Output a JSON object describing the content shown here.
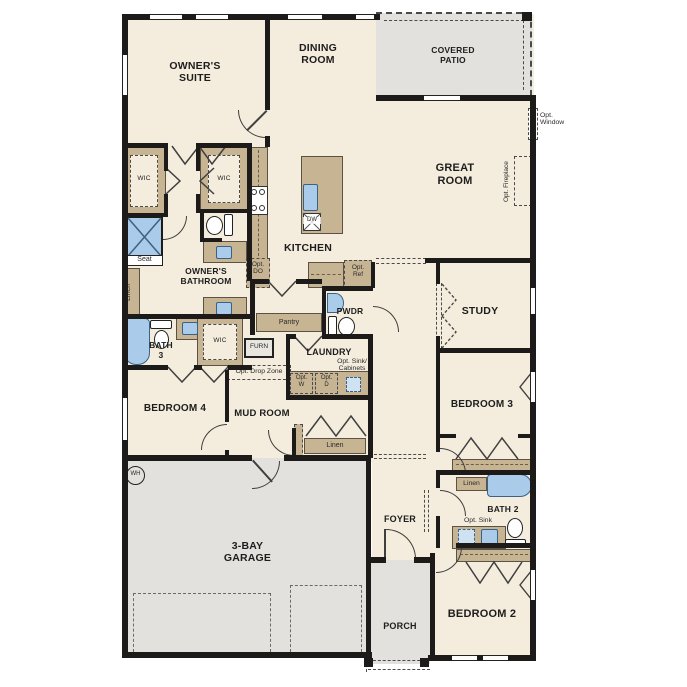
{
  "rooms": {
    "owners_suite": "OWNER'S\nSUITE",
    "dining_room": "DINING\nROOM",
    "covered_patio": "COVERED\nPATIO",
    "great_room": "GREAT\nROOM",
    "kitchen": "KITCHEN",
    "owners_bathroom": "OWNER'S\nBATHROOM",
    "wic_left": "WIC",
    "wic_mid": "WIC",
    "wic_bedroom4": "WIC",
    "bath_3": "BATH\n3",
    "bedroom_4": "BEDROOM 4",
    "mud_room": "MUD ROOM",
    "laundry": "LAUNDRY",
    "pwdr": "PWDR",
    "study": "STUDY",
    "bedroom_3": "BEDROOM 3",
    "bath_2": "BATH 2",
    "bedroom_2": "BEDROOM 2",
    "foyer": "FOYER",
    "porch": "PORCH",
    "garage": "3-BAY\nGARAGE"
  },
  "ann": {
    "seat": "Seat",
    "linen_owner": "Linen",
    "linen_hall": "Linen",
    "linen_bath2": "Linen",
    "pantry": "Pantry",
    "furn": "FURN",
    "dw": "DW",
    "wh": "WH",
    "opt_do": "Opt.\nDO",
    "opt_ref": "Opt.\nRef",
    "opt_drop_zone": "Opt. Drop Zone",
    "opt_w": "Opt.\nW",
    "opt_d": "Opt.\nD",
    "opt_sink_cabinets": "Opt. Sink/\nCabinets",
    "opt_sink": "Opt. Sink",
    "opt_window": "Opt.\nWindow",
    "opt_fireplace": "Opt. Fireplace"
  },
  "colors": {
    "floor": "#f4eddd",
    "exterior_concrete": "#e3e1dd",
    "wall": "#1c1b1a",
    "cabinet_tan": "#c7b493",
    "fixture_blue": "#aacbe9",
    "optional_dash": "#4a4a4a"
  }
}
